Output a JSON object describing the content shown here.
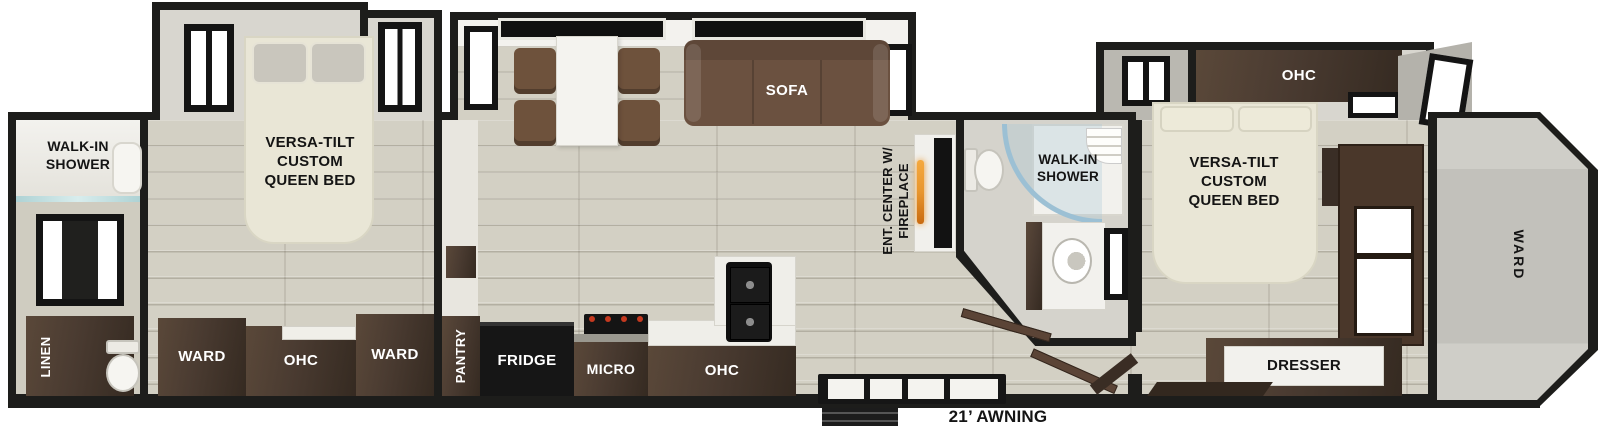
{
  "floorplan": {
    "awning_label": "21’ AWNING",
    "rear_bath": {
      "shower_label": "WALK-IN SHOWER",
      "linen_label": "LINEN"
    },
    "rear_bedroom": {
      "bed_label": "VERSA-TILT CUSTOM QUEEN BED",
      "ward_left_label": "WARD",
      "ohc_label": "OHC",
      "ward_right_label": "WARD"
    },
    "living_kitchen": {
      "sofa_label": "SOFA",
      "pantry_label": "PANTRY",
      "fridge_label": "FRIDGE",
      "micro_label": "MICRO",
      "ohc_label": "OHC",
      "ent_center_label": "ENT. CENTER W/ FIREPLACE"
    },
    "mid_bath": {
      "shower_label": "WALK-IN SHOWER"
    },
    "front_bedroom": {
      "ohc_label": "OHC",
      "bed_label": "VERSA-TILT CUSTOM QUEEN BED",
      "dresser_label": "DRESSER"
    },
    "front_cap": {
      "ward_label": "WARD"
    },
    "colors": {
      "wall": "#1d1d1b",
      "floor_wood": "#d3d0c4",
      "cabinet_brown": "#4a3b31",
      "sofa_brown": "#6b5140",
      "bed_cream": "#e9e6d6",
      "shower_glass": "#9cc0d4",
      "fireplace_flame": "#e8962e",
      "appliance_black": "#161616"
    }
  }
}
